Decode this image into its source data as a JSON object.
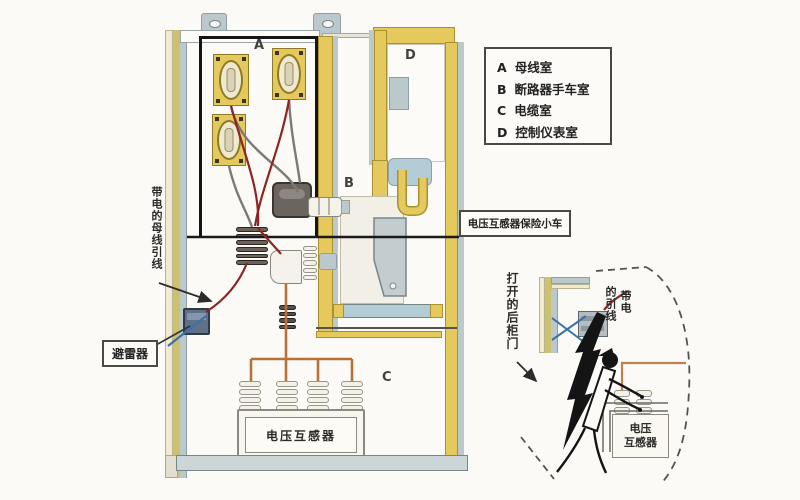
{
  "legend": {
    "items": [
      {
        "key": "A",
        "label": "母线室"
      },
      {
        "key": "B",
        "label": "断路器手车室"
      },
      {
        "key": "C",
        "label": "电缆室"
      },
      {
        "key": "D",
        "label": "控制仪表室"
      }
    ]
  },
  "compartments": {
    "a": "A",
    "b": "B",
    "c": "C",
    "d": "D"
  },
  "callouts": {
    "vt_fuse_cart": "电压互感器保险小车",
    "arrester": "避雷器",
    "vt_main": "电压互感器",
    "busbar_lead": "带电的母线引线",
    "open_rear_door": "打开的后柜门",
    "live_lead_part1": "带电",
    "live_lead_part2": "的引线",
    "vt_inset_line1": "电压",
    "vt_inset_line2": "互感器"
  },
  "colors": {
    "frame_yellow": "#e6c95c",
    "panel_gray": "#bcc9cc",
    "wire_red": "#8e2424",
    "wire_orange": "#b5713a",
    "wire_blue": "#3c6fae",
    "outline_black": "#141414"
  }
}
